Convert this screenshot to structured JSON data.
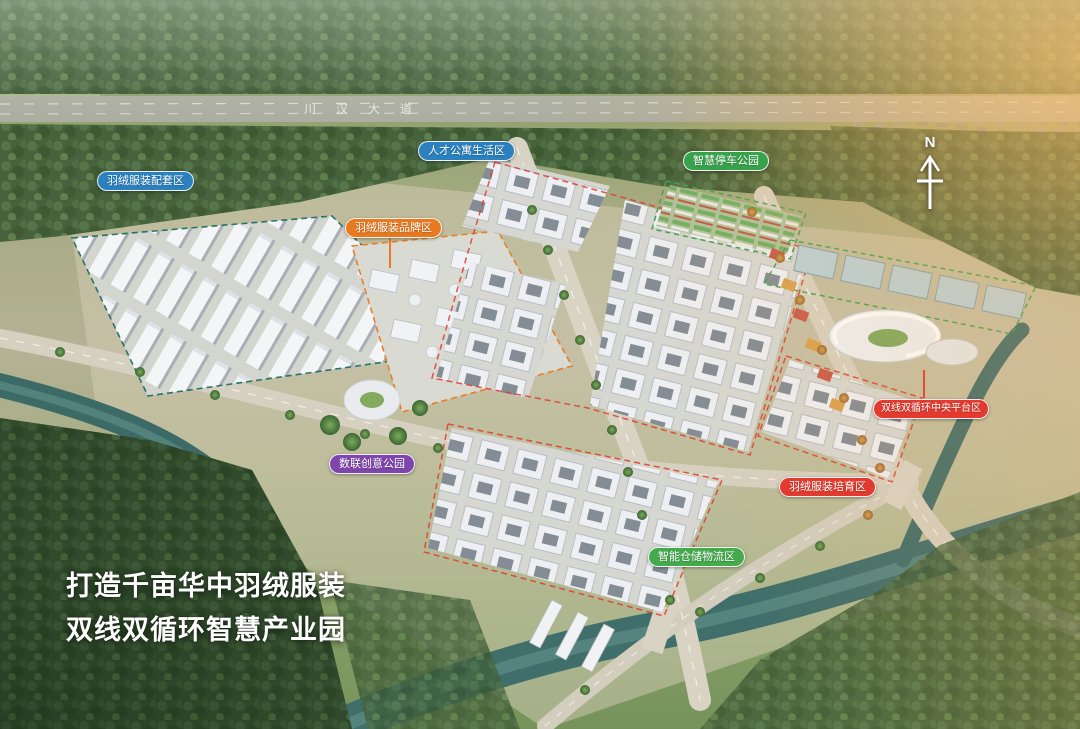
{
  "overlay": {
    "slogan": {
      "line1": "打造千亩华中羽绒服装",
      "line2": "双线双循环智慧产业园"
    },
    "north": {
      "label": "N"
    },
    "roads": {
      "top_avenue_label": "川汉大道"
    },
    "labels": {
      "peitao": {
        "text": "羽绒服装配套区",
        "color": "#2b80bd"
      },
      "pinpai": {
        "text": "羽绒服装品牌区",
        "color": "#e8791f"
      },
      "rencai": {
        "text": "人才公寓生活区",
        "color": "#2b80bd"
      },
      "tingche": {
        "text": "智慧停车公园",
        "color": "#38a14c"
      },
      "shulian": {
        "text": "数联创意公园",
        "color": "#7e46ab"
      },
      "zhongyang": {
        "text": "双线双循环中央平台区",
        "color": "#e23a2e"
      },
      "peiyu": {
        "text": "羽绒服装培育区",
        "color": "#e23a2e"
      },
      "cangchu": {
        "text": "智能仓储物流区",
        "color": "#45a94d"
      }
    }
  }
}
